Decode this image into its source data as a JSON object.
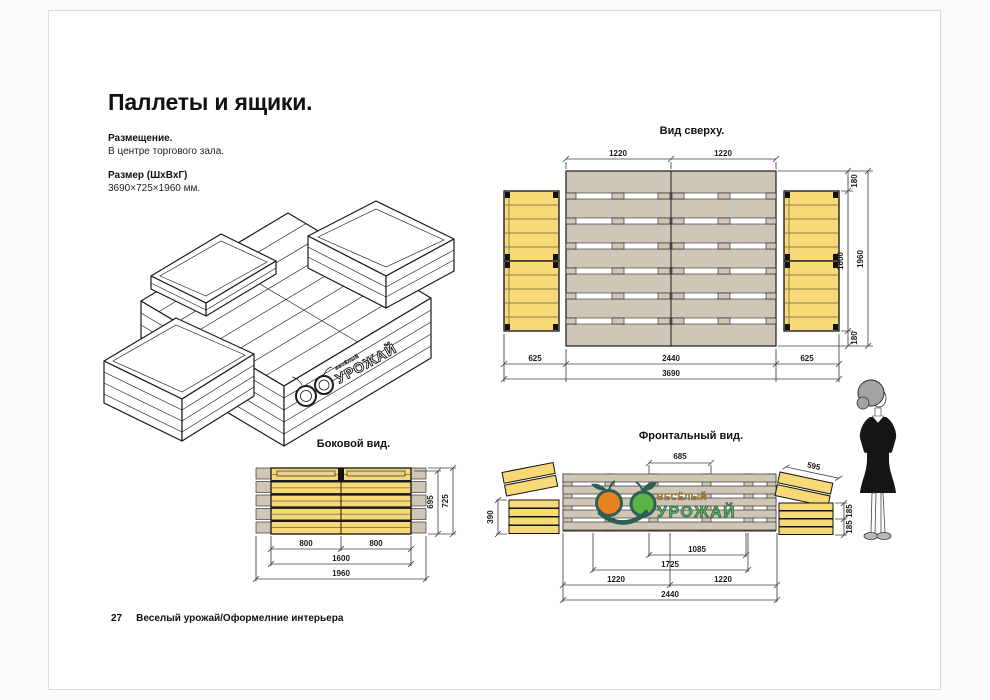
{
  "page": {
    "title": "Паллеты и ящики.",
    "placement_label": "Размещение.",
    "placement_value": "В центре торгового зала.",
    "size_label": "Размер (ШхВхГ)",
    "size_value": "3690×725×1960 мм.",
    "footer": {
      "page_number": "27",
      "text": "Веселый урожай/Оформелние интерьера"
    }
  },
  "views": {
    "top": {
      "title": "Вид сверху.",
      "dims": {
        "pallet_left_width": "1220",
        "pallet_right_width": "1220",
        "right_top_offset": "180",
        "right_inner_depth": "1600",
        "right_total_depth": "1960",
        "right_bottom_offset": "180",
        "bottom_left_crate": "625",
        "bottom_pallet": "2440",
        "bottom_right_crate": "625",
        "bottom_total": "3690"
      }
    },
    "side": {
      "title": "Боковой вид.",
      "dims": {
        "height_inner": "695",
        "height_total": "725",
        "bottom_left_half": "800",
        "bottom_right_half": "800",
        "bottom_inner": "1600",
        "bottom_total": "1960"
      }
    },
    "front": {
      "title": "Фронтальный вид.",
      "dims": {
        "top_center": "685",
        "tilted_crate": "595",
        "left_stack_height": "390",
        "right_upper": "185",
        "right_lower": "185",
        "center_inner": "1085",
        "center_outer": "1725",
        "bottom_left_half": "1220",
        "bottom_right_half": "1220",
        "bottom_total": "2440"
      }
    }
  },
  "logo": {
    "brand_top": "ВЕСЁЛЫЙ",
    "brand_main": "УРОЖАЙ",
    "iso_top": "весёлый",
    "iso_main": "УРОЖАЙ"
  },
  "colors": {
    "pallet_tan": "#cfc6b8",
    "crate_yellow": "#f8d977",
    "logo_orange": "#e8821e",
    "logo_green": "#5bb347",
    "logo_dark": "#2f5d53"
  }
}
